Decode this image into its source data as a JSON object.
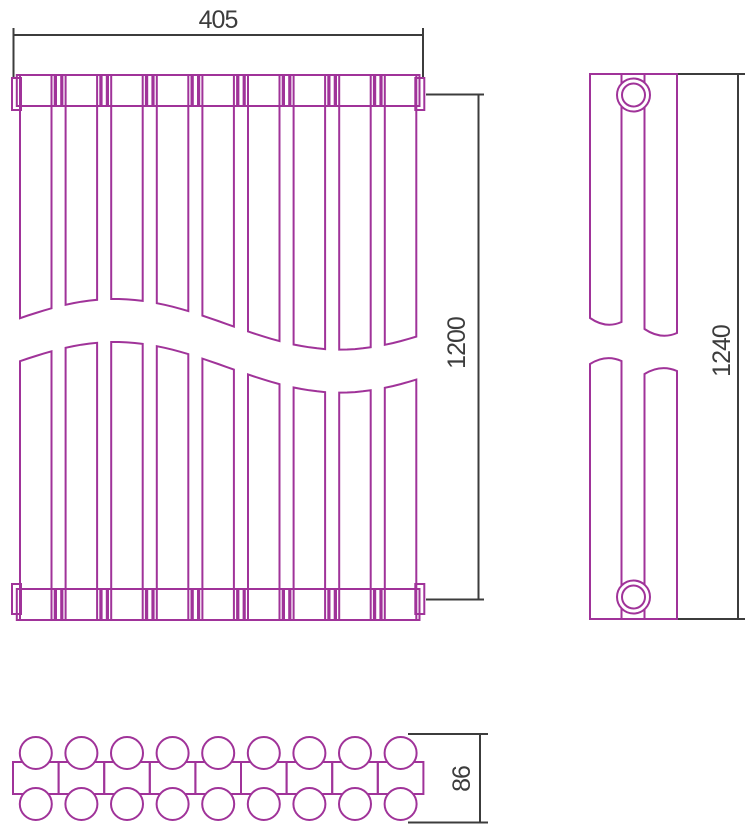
{
  "colors": {
    "drawing_line": "#A03399",
    "dimension_line": "#3C3C3C",
    "background": "#FFFFFF"
  },
  "dimension_labels": {
    "width": "405",
    "connection_height": "1200",
    "overall_height": "1240",
    "depth": "86"
  },
  "drawing": {
    "front_view": {
      "sections": 9,
      "x0": 20,
      "top": 75,
      "bottom": 620,
      "pitch": 45.6,
      "panel_width": 31.5,
      "shoulder_height": 31,
      "wave": {
        "mean": 345.8,
        "amplitude": 25.3,
        "period": 450,
        "crest_x": 115,
        "half_gap": 21.5
      },
      "end_caps": [
        {
          "x": 12,
          "y": 78,
          "w": 9,
          "h": 32
        },
        {
          "x": 415.3,
          "y": 78,
          "w": 9,
          "h": 32
        },
        {
          "x": 12,
          "y": 584,
          "w": 9,
          "h": 30
        },
        {
          "x": 415.3,
          "y": 584,
          "w": 9,
          "h": 30
        }
      ]
    },
    "side_view": {
      "left": 590,
      "right": 677,
      "top": 74,
      "bottom": 619,
      "slat_a": {
        "x1": 590,
        "x2": 621.5,
        "gap_top": [
          318,
          322
        ],
        "gap_bottom": [
          364,
          361
        ]
      },
      "slat_b": {
        "x1": 644.5,
        "x2": 677,
        "gap_top": [
          329,
          333
        ],
        "gap_bottom": [
          374,
          371
        ]
      },
      "circle_cx": 633.5,
      "circle_top_cy": 95,
      "circle_bottom_cy": 597,
      "circle_r_outer": 16.5,
      "circle_r_inner": 11.5
    },
    "top_view": {
      "sections": 9,
      "x0": 13,
      "pitch": 45.6,
      "band_top": 762,
      "band_bottom": 794,
      "circle_r": 16,
      "top_row_cy": 753,
      "bottom_row_cy": 804
    }
  }
}
